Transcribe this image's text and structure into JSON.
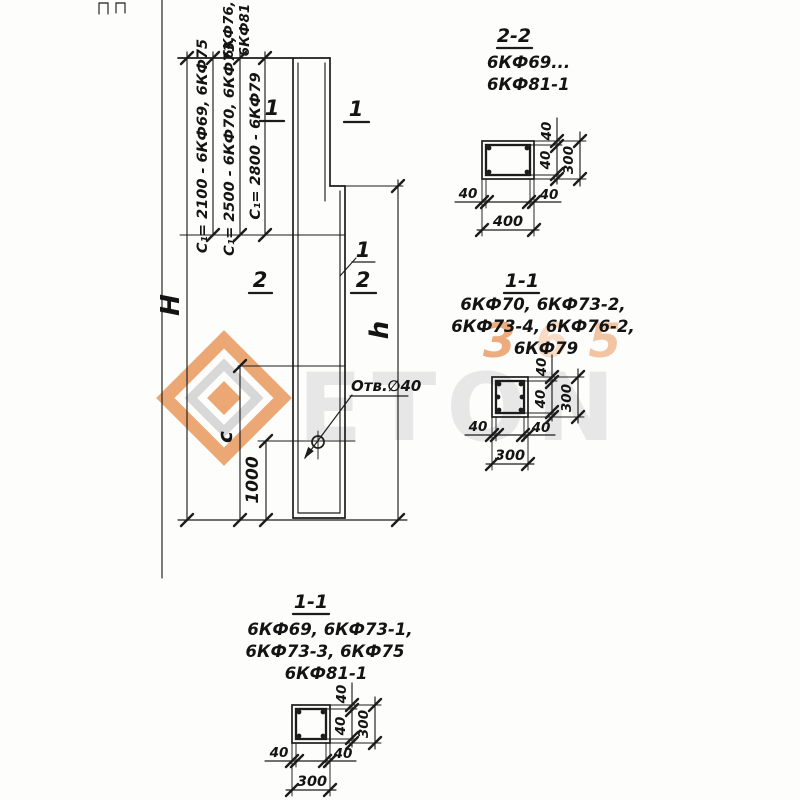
{
  "watermark": {
    "letters": "ETON",
    "digit1": "3",
    "digit2": "6",
    "digit3": "5",
    "orange": "#e9995d",
    "gray": "#e4e4e4"
  },
  "main": {
    "dim_H": "H",
    "dim_h": "h",
    "dim_c": "c",
    "dim_1000": "1000",
    "c1_2100": "C₁= 2100 - 6КФ69, 6КФ75",
    "c1_2500": "C₁= 2500 - 6КФ70, 6КФ73,",
    "c1_2500_cont1": "6КФ76,",
    "c1_2500_cont2": "6КФ81",
    "c1_2800": "C₁= 2800 - 6КФ79",
    "hole_label": "Отв.∅40",
    "mark_top_left": "1",
    "mark_top_right": "1",
    "mark_mid_left": "2",
    "mark_mid_right_1": "1",
    "mark_mid_right_2": "2"
  },
  "section_2_2": {
    "title": "2-2",
    "types_line1": "6КФ69...",
    "types_line2": "6КФ81-1",
    "cover_top": "40",
    "cover_bottom": "40",
    "height": "300",
    "cover_left": "40",
    "cover_right": "40",
    "width": "400"
  },
  "section_1_1_mid": {
    "title": "1-1",
    "types_line1": "6КФ70, 6КФ73-2,",
    "types_line2": "6КФ73-4, 6КФ76-2,",
    "types_line3": "6КФ79",
    "cover_top": "40",
    "cover_bottom": "40",
    "height": "300",
    "cover_left": "40",
    "cover_right": "40",
    "width": "300"
  },
  "section_1_1_bottom": {
    "title": "1-1",
    "types_line1": "6КФ69, 6КФ73-1,",
    "types_line2": "6КФ73-3, 6КФ75",
    "types_line3": "6КФ81-1",
    "cover_top": "40",
    "cover_bottom": "40",
    "height": "300",
    "cover_left": "40",
    "cover_right": "40",
    "width": "300"
  }
}
